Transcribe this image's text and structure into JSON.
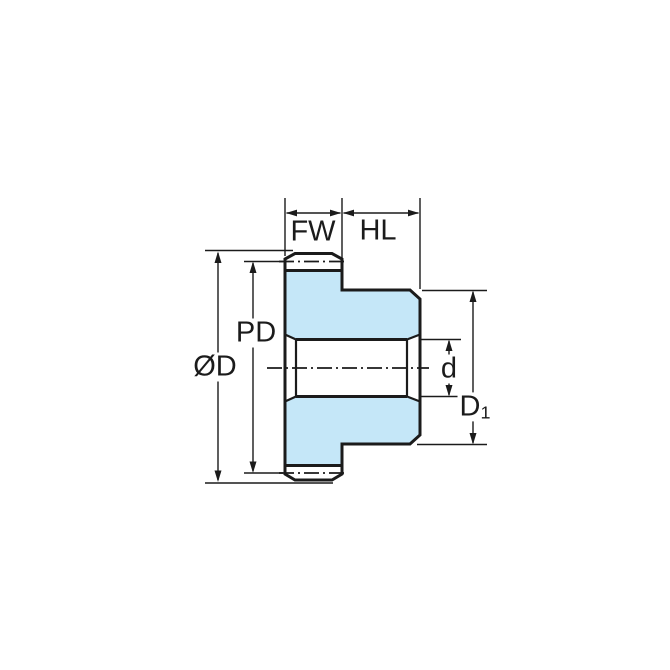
{
  "figure": {
    "kind": "gear-cross-section-dimension-drawing",
    "colors": {
      "part_fill": "#C5E7F8",
      "line": "#1B1B1B",
      "background": "#FFFFFF"
    }
  },
  "labels": {
    "fw": "FW",
    "hl": "HL",
    "pd": "PD",
    "od": "ØD",
    "d": "d",
    "d1_main": "D",
    "d1_sub": "1"
  }
}
